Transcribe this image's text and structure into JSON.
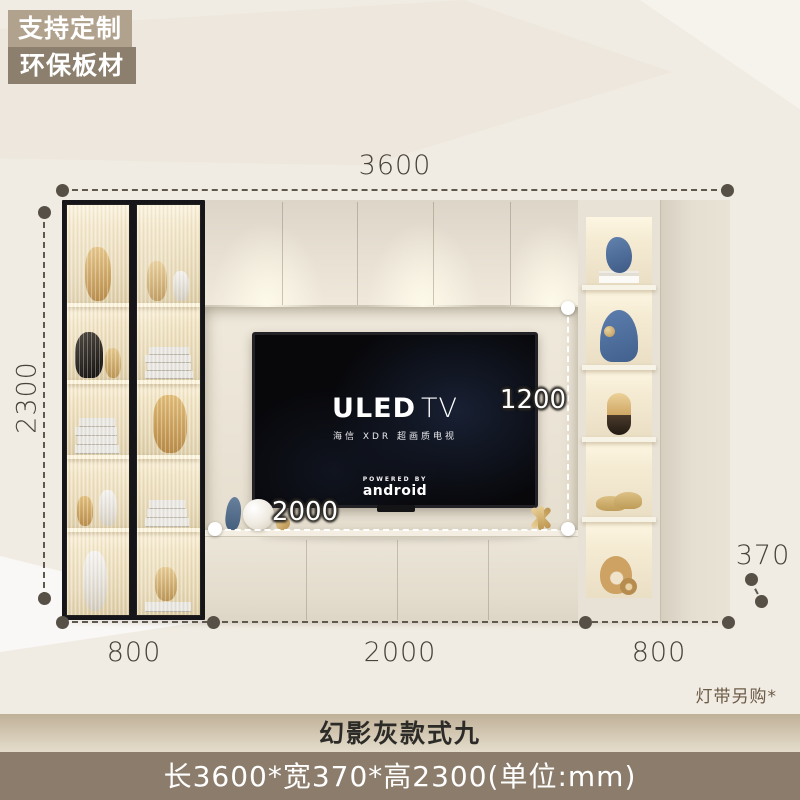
{
  "badges": [
    {
      "label": "支持定制"
    },
    {
      "label": "环保板材"
    }
  ],
  "dimensions": {
    "width_total": "3600",
    "height_total": "2300",
    "niche_height": "1200",
    "niche_width": "2000",
    "left_section_width": "800",
    "middle_section_width": "2000",
    "right_section_width": "800",
    "depth": "370"
  },
  "tv": {
    "logo_main": "ULED",
    "logo_sub": "TV",
    "tagline": "海信 XDR 超画质电视",
    "powered_by": "POWERED BY",
    "os_name": "android"
  },
  "note_light_strip": "灯带另购*",
  "footer": {
    "style_name": "幻影灰款式九",
    "spec_line": "长3600*宽370*高2300(单位:mm)"
  },
  "colors": {
    "background": "#f1ece3",
    "badge_light": "#b1a28d",
    "badge_dark": "#8d7f6e",
    "cabinet_cream": "#e7e0d3",
    "dimension_dark": "#575046",
    "footer_bar": "#8b7c6b"
  }
}
